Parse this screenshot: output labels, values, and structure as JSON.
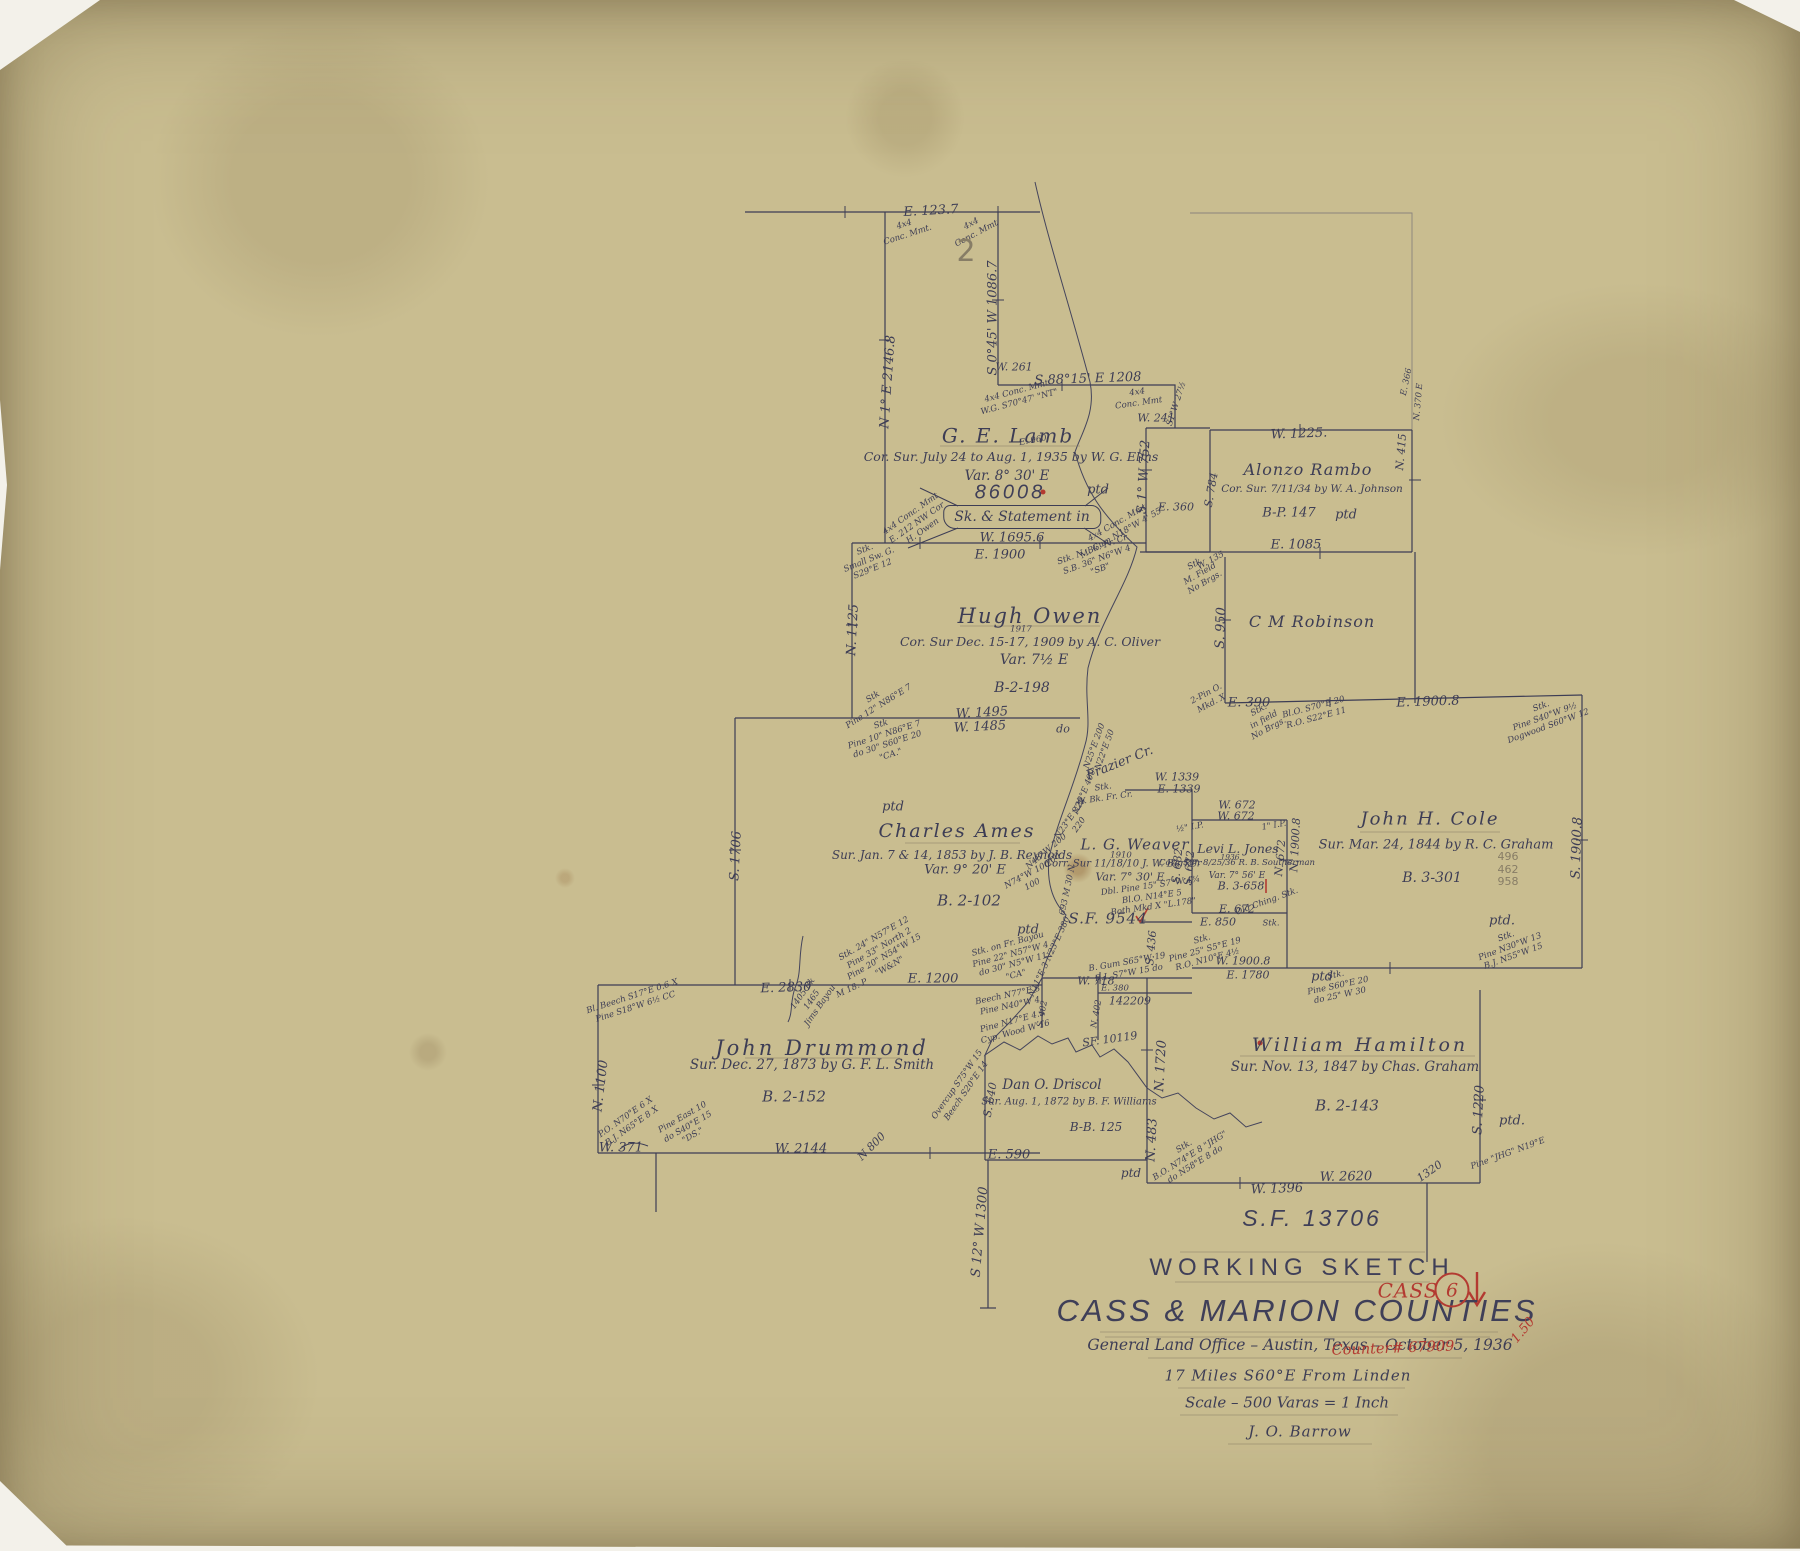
{
  "title_block": {
    "file_no": "S.F. 13706",
    "line1": "WORKING  SKETCH",
    "line2": "CASS & MARION  COUNTIES",
    "line3": "General Land Office – Austin, Texas – October 5, 1936",
    "line4": "17 Miles S60°E  From  Linden",
    "line5": "Scale – 500 Varas = 1 Inch",
    "line6": "J. O. Barrow"
  },
  "stamps": {
    "county": "CASS",
    "number": "6",
    "price": "1.50",
    "counter": "Counter# 67909"
  },
  "surveys": {
    "lamb": {
      "name": "G. E. Lamb",
      "note": "Cor. Sur. July 24 to Aug. 1, 1935 by W. G. Elms",
      "var": "Var. 8° 30' E",
      "file": "86008",
      "ptd": "ptd",
      "statement": "Sk. & Statement in"
    },
    "owen": {
      "name": "Hugh  Owen",
      "year": "1917",
      "note": "Cor. Sur Dec. 15-17, 1909 by A. C. Oliver",
      "var": "Var. 7½ E",
      "ref": "B-2-198"
    },
    "rambo": {
      "name": "Alonzo  Rambo",
      "note": "Cor. Sur. 7/11/34 by W. A. Johnson",
      "ref": "B-P. 147",
      "ptd": "ptd"
    },
    "robinson": {
      "name": "C M Robinson"
    },
    "ames": {
      "name": "Charles  Ames",
      "note": "Sur. Jan. 7 & 14, 1853 by J. B. Reynolds",
      "var": "Var. 9° 20' E",
      "ref": "B. 2-102",
      "ptd": "ptd"
    },
    "weaver": {
      "name": "L. G. Weaver",
      "year": "1910",
      "note": "Corr. Sur 11/18/10  J. W. Barker",
      "var": "Var. 7° 30' E",
      "file": "S.F. 9544"
    },
    "jones": {
      "name": "Levi L. Jones",
      "year": "1936",
      "note": "Corr. Sur. 8/25/36  R. B. Southerman",
      "var": "Var. 7° 56' E",
      "ref": "B. 3-658"
    },
    "cole": {
      "name": "John  H.  Cole",
      "note": "Sur. Mar. 24, 1844 by R. C. Graham",
      "ref": "B. 3-301",
      "ptd": "ptd."
    },
    "drummond": {
      "name": "John  Drummond",
      "note": "Sur. Dec. 27, 1873 by G. F. L. Smith",
      "ref": "B. 2-152"
    },
    "driscol": {
      "name": "Dan O. Driscol",
      "note": "Sur. Aug. 1, 1872 by B. F. Williams",
      "ref": "B-B. 125",
      "ptd": "ptd"
    },
    "hamilton": {
      "name": "William  Hamilton",
      "note": "Sur. Nov. 13, 1847 by Chas. Graham",
      "ref": "B. 2-143",
      "ptd": "ptd."
    }
  },
  "labels": {
    "e123_7": "E. 123.7",
    "mmt_a": "4x4\nConc. Mmt.",
    "mmt_b": "4x4\nConc. Mmt",
    "pencil2": "2",
    "s045w": "S 0°45' W 1086.7",
    "n1e2146": "N 1° E 2146.8",
    "s8815e": "S 88°15' E 1208",
    "mmt_c": "4x4 Conc. Mmt\nW.G. S70°47' \"NT\"",
    "mmt_d": "4x4\nConc. Mmt",
    "w241": "W. 241",
    "s1w27": "S1°W 27½",
    "w261": "W. 261",
    "s1w752": "S 1° W 752",
    "e360": "E. 360",
    "s784": "S. 784",
    "w1225": "W. 1225.",
    "e366": "E. 366",
    "n370e": "N. 370 E",
    "n415": "N. 415",
    "e1085": "E. 1085",
    "w16956": "W. 1695.6",
    "e1900": "E. 1900",
    "mmt_e": "4x4 Conc. Mmt\nE. 212 NW Cor\nH. Owen",
    "mmt_f": "4x4 Conc. Mmt\nM. Gum N18°W 4' 55\"",
    "stk_sw": "Stk.\nSmall Sw. G.\nS29°E 12",
    "stk_nbk": "Stk. N. Bk. Fr. Cr.\nS.B. 36\" N6°W 4\n\"SB\"",
    "e960": "E. 960",
    "n1125": "N. 1125",
    "s950": "S. 950",
    "w135": "W. 135",
    "stk_mf": "Stk\nM. Field\nNo Brgs.",
    "e390": "E. 390",
    "pin_o": "2-Pin O.\nMkd. X",
    "stk_if": "Stk.\nin field\nNo Brgs.",
    "blo": "Bl.O. S70°E 20\nR.O. S22°E 11",
    "e19008": "E. 1900.8",
    "stk_pine_dw": "Stk.\nPine S40°W 9½\nDogwood S60°W 12",
    "w1495": "W. 1495",
    "w1485": "W. 1485",
    "stk_p12": "Stk\nPine 12\" N86°E 7",
    "stk_p10": "Stk\nPine 10\" N86°E 7\ndo 30\" S60°E 20\n\"CA.\"",
    "s1706": "S. 1706",
    "do1": "do",
    "cr1": "N25°E 200\nN22°E 50",
    "cr2": "N22°E 400",
    "cr3": "N23°E 228\n220",
    "cr4": "N48°W 200\n200",
    "cr5": "N74°W 100\n100",
    "cr6": "693 M 30 N",
    "cr7": "N11°E 3   N23°E 380",
    "frazier": "Frazier Cr.",
    "stk_wbk": "Stk.\nW. Bk. Fr. Cr.",
    "w1339": "W. 1339",
    "e1339": "E. 1339",
    "w672a": "W. 672",
    "w672b": "W. 672",
    "ip_half": "½\" I.P.",
    "ip_one": "1\" I.P.",
    "s682": "S. 682",
    "s672": "S. 672",
    "n672": "N. 672",
    "n19008": "N. 1900.8",
    "e672": "E. 672",
    "e850": "E. 850",
    "dbl_pine": "Dbl. Pine 15\" S7°W 4¾\nBl.O. N14°E 5\nBoth Mkd X  \"L.178\"",
    "old_ching": "Old Ching. Stk.",
    "stk1": "Stk.",
    "s436": "S. 436",
    "w718": "W. 718",
    "e380": "E. 380",
    "n142209": "142209",
    "bgum": "B. Gum S65°W 19\nR.I. S7°W 15 do",
    "stk_p25": "Stk.\nPine 25\" S5°E 19\nR.O. N10°E 4½",
    "w19008": "W. 1900.8",
    "e1780": "E. 1780",
    "s19008": "S. 1900.8",
    "stk_p30": "Stk.\nPine N30°W 13\nB.J. N55°W 15",
    "stk_p60": "Stk.\nPine S60°E 20\ndo 25\" W 30",
    "figs": "496\n462\n958",
    "e2830": "E. 2830",
    "jims": "1405 Bk\n1465\nJims Bayou",
    "m18p": "M 18. P",
    "stk24": "Stk. 24\" N57°E 12\nPine 33\" North 2\nPine 20\" N54°W 15\n\"W&N\"",
    "e1200": "E. 1200",
    "stk_fb": "Stk. on Fr. Bayou\nPine 22\" N57°W 4\ndo 30\" N5°W 11\n\"CA\"",
    "beech": "Beech N77°E 8\nPine N40°W 4",
    "pine_cyp": "Pine N17°E 4.5\nCyp. Wood W 16",
    "blbeech": "Bl. Beech S17°E 0.6 X\nPine S18°W 6½ CC",
    "n1100": "N. 1100",
    "po_bj": "P.O. N70°E 6 X\nB.J. N65°E 8 X",
    "pine_e10": "Pine East 10\ndo S40°E 15\n\"DS.\"",
    "w371": "W. 371",
    "w2144": "W. 2144",
    "n800": "N 800",
    "overcup": "Overcup S75°W 15\nBeech S20°E 14",
    "s640": "S. 640",
    "e590": "E. 590",
    "s12w1300": "S 12° W 1300",
    "s402": "S. 402",
    "n402": "N. 402",
    "sf10119": "SF. 10119",
    "n1720": "N. 1720",
    "n483": "N. 483",
    "stk_bo": "Stk.\nB.O. N74°E 8 \"JHG\"\ndo N58°E 8 do",
    "w2620": "W. 2620",
    "w1396": "W. 1396",
    "t1320": "1320",
    "s1220": "S. 1220",
    "pine_jhg": "Pine \"JHG\" N19°E",
    "ptd_a": "ptd",
    "ptd_b": "ptd"
  }
}
